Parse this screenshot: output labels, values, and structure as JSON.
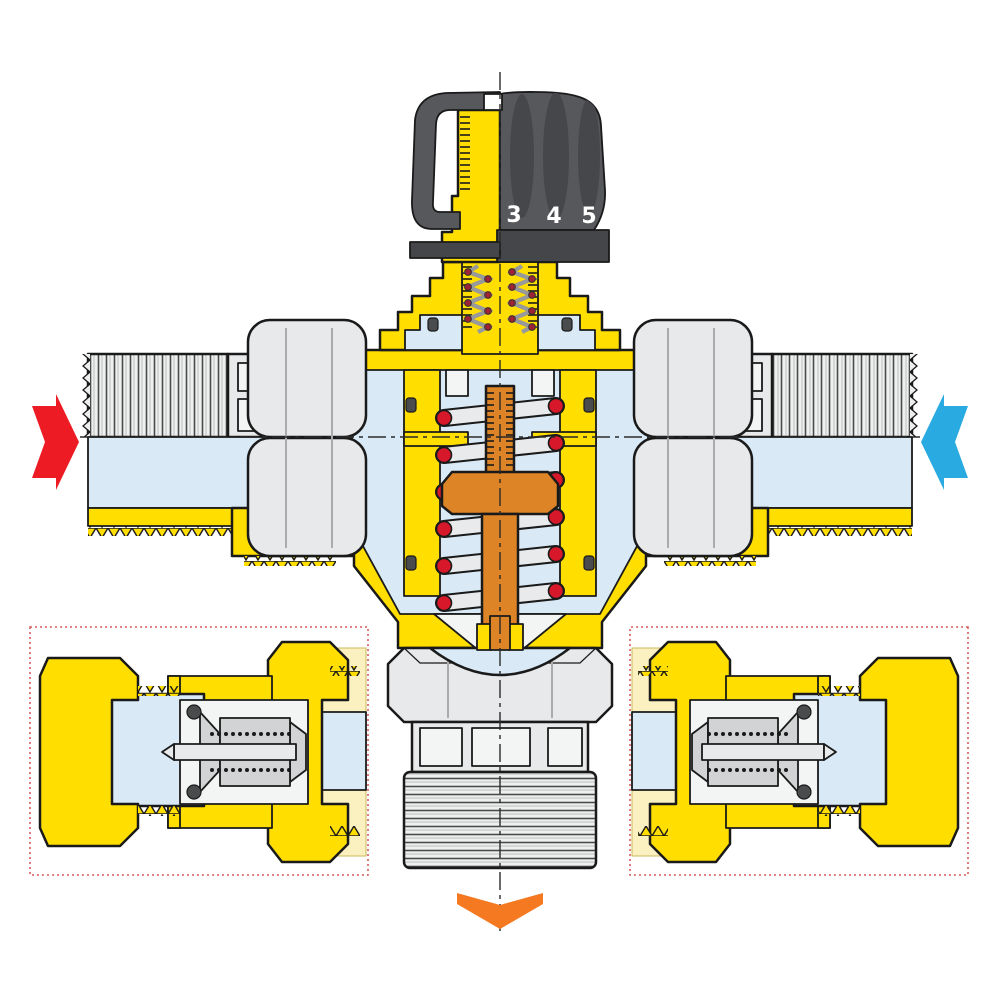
{
  "diagram": {
    "description": "thermostatic-mixing-valve-cross-section",
    "knob": {
      "scale_numbers": [
        "3",
        "4",
        "5"
      ],
      "color": "#57585B"
    },
    "arrows": {
      "hot_inlet": {
        "icon": "red-right-arrow-icon",
        "direction": "right",
        "color": "#ED1C24"
      },
      "cold_inlet": {
        "icon": "blue-left-arrow-icon",
        "direction": "left",
        "color": "#29ABE2"
      },
      "mixed_outlet": {
        "icon": "orange-down-arrow-icon",
        "direction": "down",
        "color": "#F47920"
      }
    },
    "colors": {
      "brass": "#FFDE00",
      "water": "#D9EAF6",
      "metal": "#E8E9EA",
      "piston_orange": "#DD8427",
      "spring_red": "#D7182A",
      "inset_border": "#D95B5B",
      "cream": "#FBF0C0",
      "outline": "#1A1A1A",
      "background": "#FFFFFF"
    },
    "insets": {
      "left": {
        "icon": "check-valve-detail-left"
      },
      "right": {
        "icon": "check-valve-detail-right"
      }
    }
  }
}
